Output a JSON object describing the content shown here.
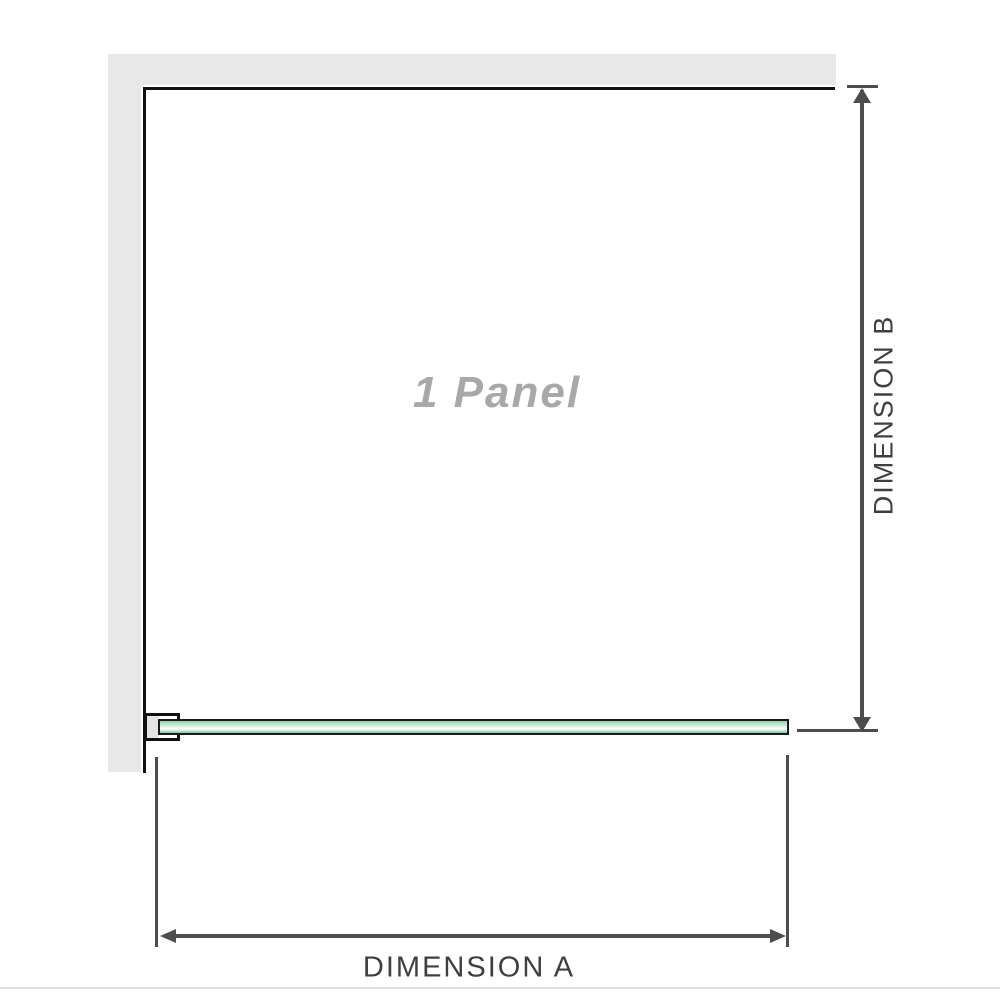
{
  "diagram": {
    "panel_label": "1 Panel",
    "dimension_a_label": "DIMENSION A",
    "dimension_b_label": "DIMENSION B"
  },
  "icons": {
    "vertical_dimension": "double-headed-arrow-vertical",
    "horizontal_dimension": "double-headed-arrow-horizontal"
  },
  "colors": {
    "wall": "#e8e8e8",
    "panel_edge": "#111111",
    "dimension_line": "#4d4d4d",
    "label_text": "#3f3f3f",
    "panel_label_text": "#a8a8a8",
    "glass_green_dark": "#8fd0ad",
    "glass_green_light": "#fbfefc",
    "glass_outline": "#1a1a1a",
    "divider": "#e0e0e0"
  }
}
